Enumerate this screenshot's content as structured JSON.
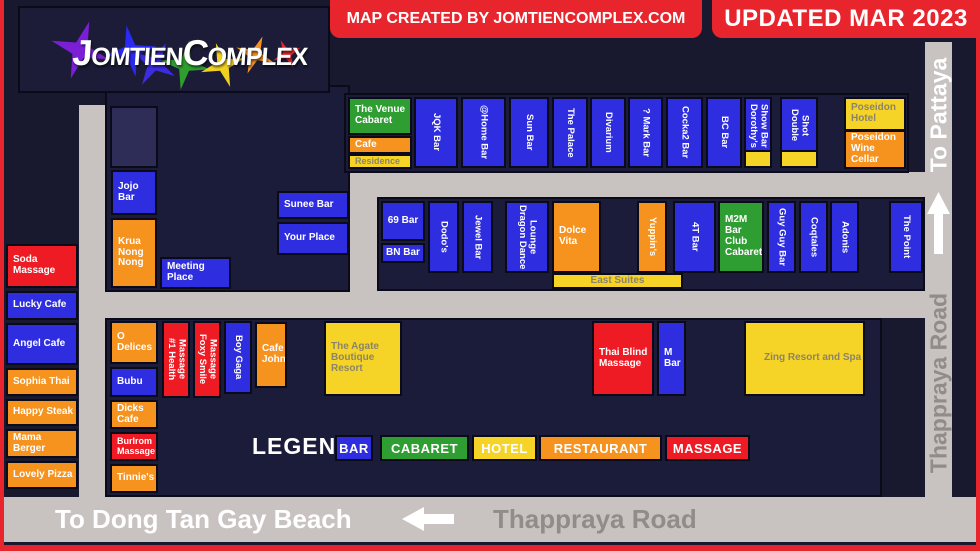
{
  "title_area": {
    "logo_part1": "Jomtien",
    "logo_part2": "Complex",
    "credit": "MAP CREATED BY JOMTIENCOMPLEX.COM",
    "updated": "UPDATED MAR 2023"
  },
  "road_labels": {
    "to_beach": "To Dong Tan Gay Beach",
    "bottom_road": "Thappraya Road",
    "to_pattaya": "To Pattaya",
    "right_road": "Thappraya Road"
  },
  "legend": {
    "title": "LEGEND",
    "items": [
      {
        "label": "BAR",
        "color": "#2e2ee0"
      },
      {
        "label": "CABARET",
        "color": "#2f9e32"
      },
      {
        "label": "HOTEL",
        "color": "#f5d327"
      },
      {
        "label": "RESTAURANT",
        "color": "#f6921e"
      },
      {
        "label": "MASSAGE",
        "color": "#ee1b24"
      }
    ]
  },
  "venues": {
    "soda": {
      "label": "Soda Massage",
      "type": "massage"
    },
    "lucky": {
      "label": "Lucky Cafe",
      "type": "bar"
    },
    "angel": {
      "label": "Angel Cafe",
      "type": "bar"
    },
    "sophia": {
      "label": "Sophia Thai",
      "type": "restaurant"
    },
    "happy": {
      "label": "Happy Steak",
      "type": "restaurant"
    },
    "mama": {
      "label": "Mama Berger",
      "type": "restaurant"
    },
    "lovely": {
      "label": "Lovely Pizza",
      "type": "restaurant"
    },
    "jojo": {
      "label": "Jojo Bar",
      "type": "bar"
    },
    "krua": {
      "label": "Krua Nong Nong",
      "type": "restaurant"
    },
    "meeting": {
      "label": "Meeting Place",
      "type": "bar"
    },
    "sunee": {
      "label": "Sunee Bar",
      "type": "bar"
    },
    "yourplace": {
      "label": "Your Place",
      "type": "bar"
    },
    "venue_cabaret": {
      "label": "The Venue Cabaret",
      "type": "cabaret"
    },
    "cafe": {
      "label": "Cafe",
      "type": "restaurant"
    },
    "residence": {
      "label": "Residence",
      "type": "hotel"
    },
    "jqk": {
      "label": "JQK Bar",
      "type": "bar"
    },
    "home": {
      "label": "@Home Bar",
      "type": "bar"
    },
    "sun": {
      "label": "Sun Bar",
      "type": "bar"
    },
    "palace": {
      "label": "The Palace",
      "type": "bar"
    },
    "divarium": {
      "label": "Divarium",
      "type": "bar"
    },
    "qmark": {
      "label": "? Mark Bar",
      "type": "bar"
    },
    "cocka2": {
      "label": "Cocka2 Bar",
      "type": "bar"
    },
    "bc": {
      "label": "BC Bar",
      "type": "bar"
    },
    "dorothys": {
      "label": "Dorothy's Show Bar",
      "type": "bar"
    },
    "dshot": {
      "label": "Double Shot",
      "type": "bar"
    },
    "poseidon_hotel": {
      "label": "Poseidon Hotel",
      "type": "hotel"
    },
    "poseidon_wine": {
      "label": "Poseidon Wine Cellar",
      "type": "restaurant"
    },
    "bar69": {
      "label": "69 Bar",
      "type": "bar"
    },
    "bn": {
      "label": "BN Bar",
      "type": "bar"
    },
    "dodos": {
      "label": "Dodo's",
      "type": "bar"
    },
    "jewel": {
      "label": "Jewel Bar",
      "type": "bar"
    },
    "dragon": {
      "label": "Dragon Dance Lounge",
      "type": "bar"
    },
    "dolce": {
      "label": "Dolce Vita",
      "type": "restaurant"
    },
    "yuppins": {
      "label": "Yuppin's",
      "type": "restaurant"
    },
    "t4": {
      "label": "4T Bar",
      "type": "bar"
    },
    "m2m": {
      "label": "M2M Bar Club Cabaret",
      "type": "cabaret"
    },
    "guyguy": {
      "label": "Guy Guy Bar",
      "type": "bar"
    },
    "coqtales": {
      "label": "Coqtales",
      "type": "bar"
    },
    "adonis": {
      "label": "Adonis",
      "type": "bar"
    },
    "point": {
      "label": "The Point",
      "type": "bar"
    },
    "east_suites": {
      "label": "East Suites",
      "type": "hotel"
    },
    "odelices": {
      "label": "O Delices",
      "type": "restaurant"
    },
    "bubu": {
      "label": "Bubu",
      "type": "bar"
    },
    "dicks": {
      "label": "Dicks Cafe",
      "type": "restaurant"
    },
    "burlrom": {
      "label": "Burlrom Massage",
      "type": "massage"
    },
    "tinnies": {
      "label": "Tinnie's",
      "type": "restaurant"
    },
    "health1": {
      "label": "#1 Health Massage",
      "type": "massage"
    },
    "foxy": {
      "label": "Foxy Smile Massage",
      "type": "massage"
    },
    "boygaga": {
      "label": "Boy Gaga",
      "type": "bar"
    },
    "cafejohn": {
      "label": "Cafe John",
      "type": "restaurant"
    },
    "agate": {
      "label": "The Agate Boutique Resort",
      "type": "hotel"
    },
    "thaiblind": {
      "label": "Thai Blind Massage",
      "type": "massage"
    },
    "mbar": {
      "label": "M Bar",
      "type": "bar"
    },
    "zing": {
      "label": "Zing Resort and Spa",
      "type": "hotel"
    }
  }
}
